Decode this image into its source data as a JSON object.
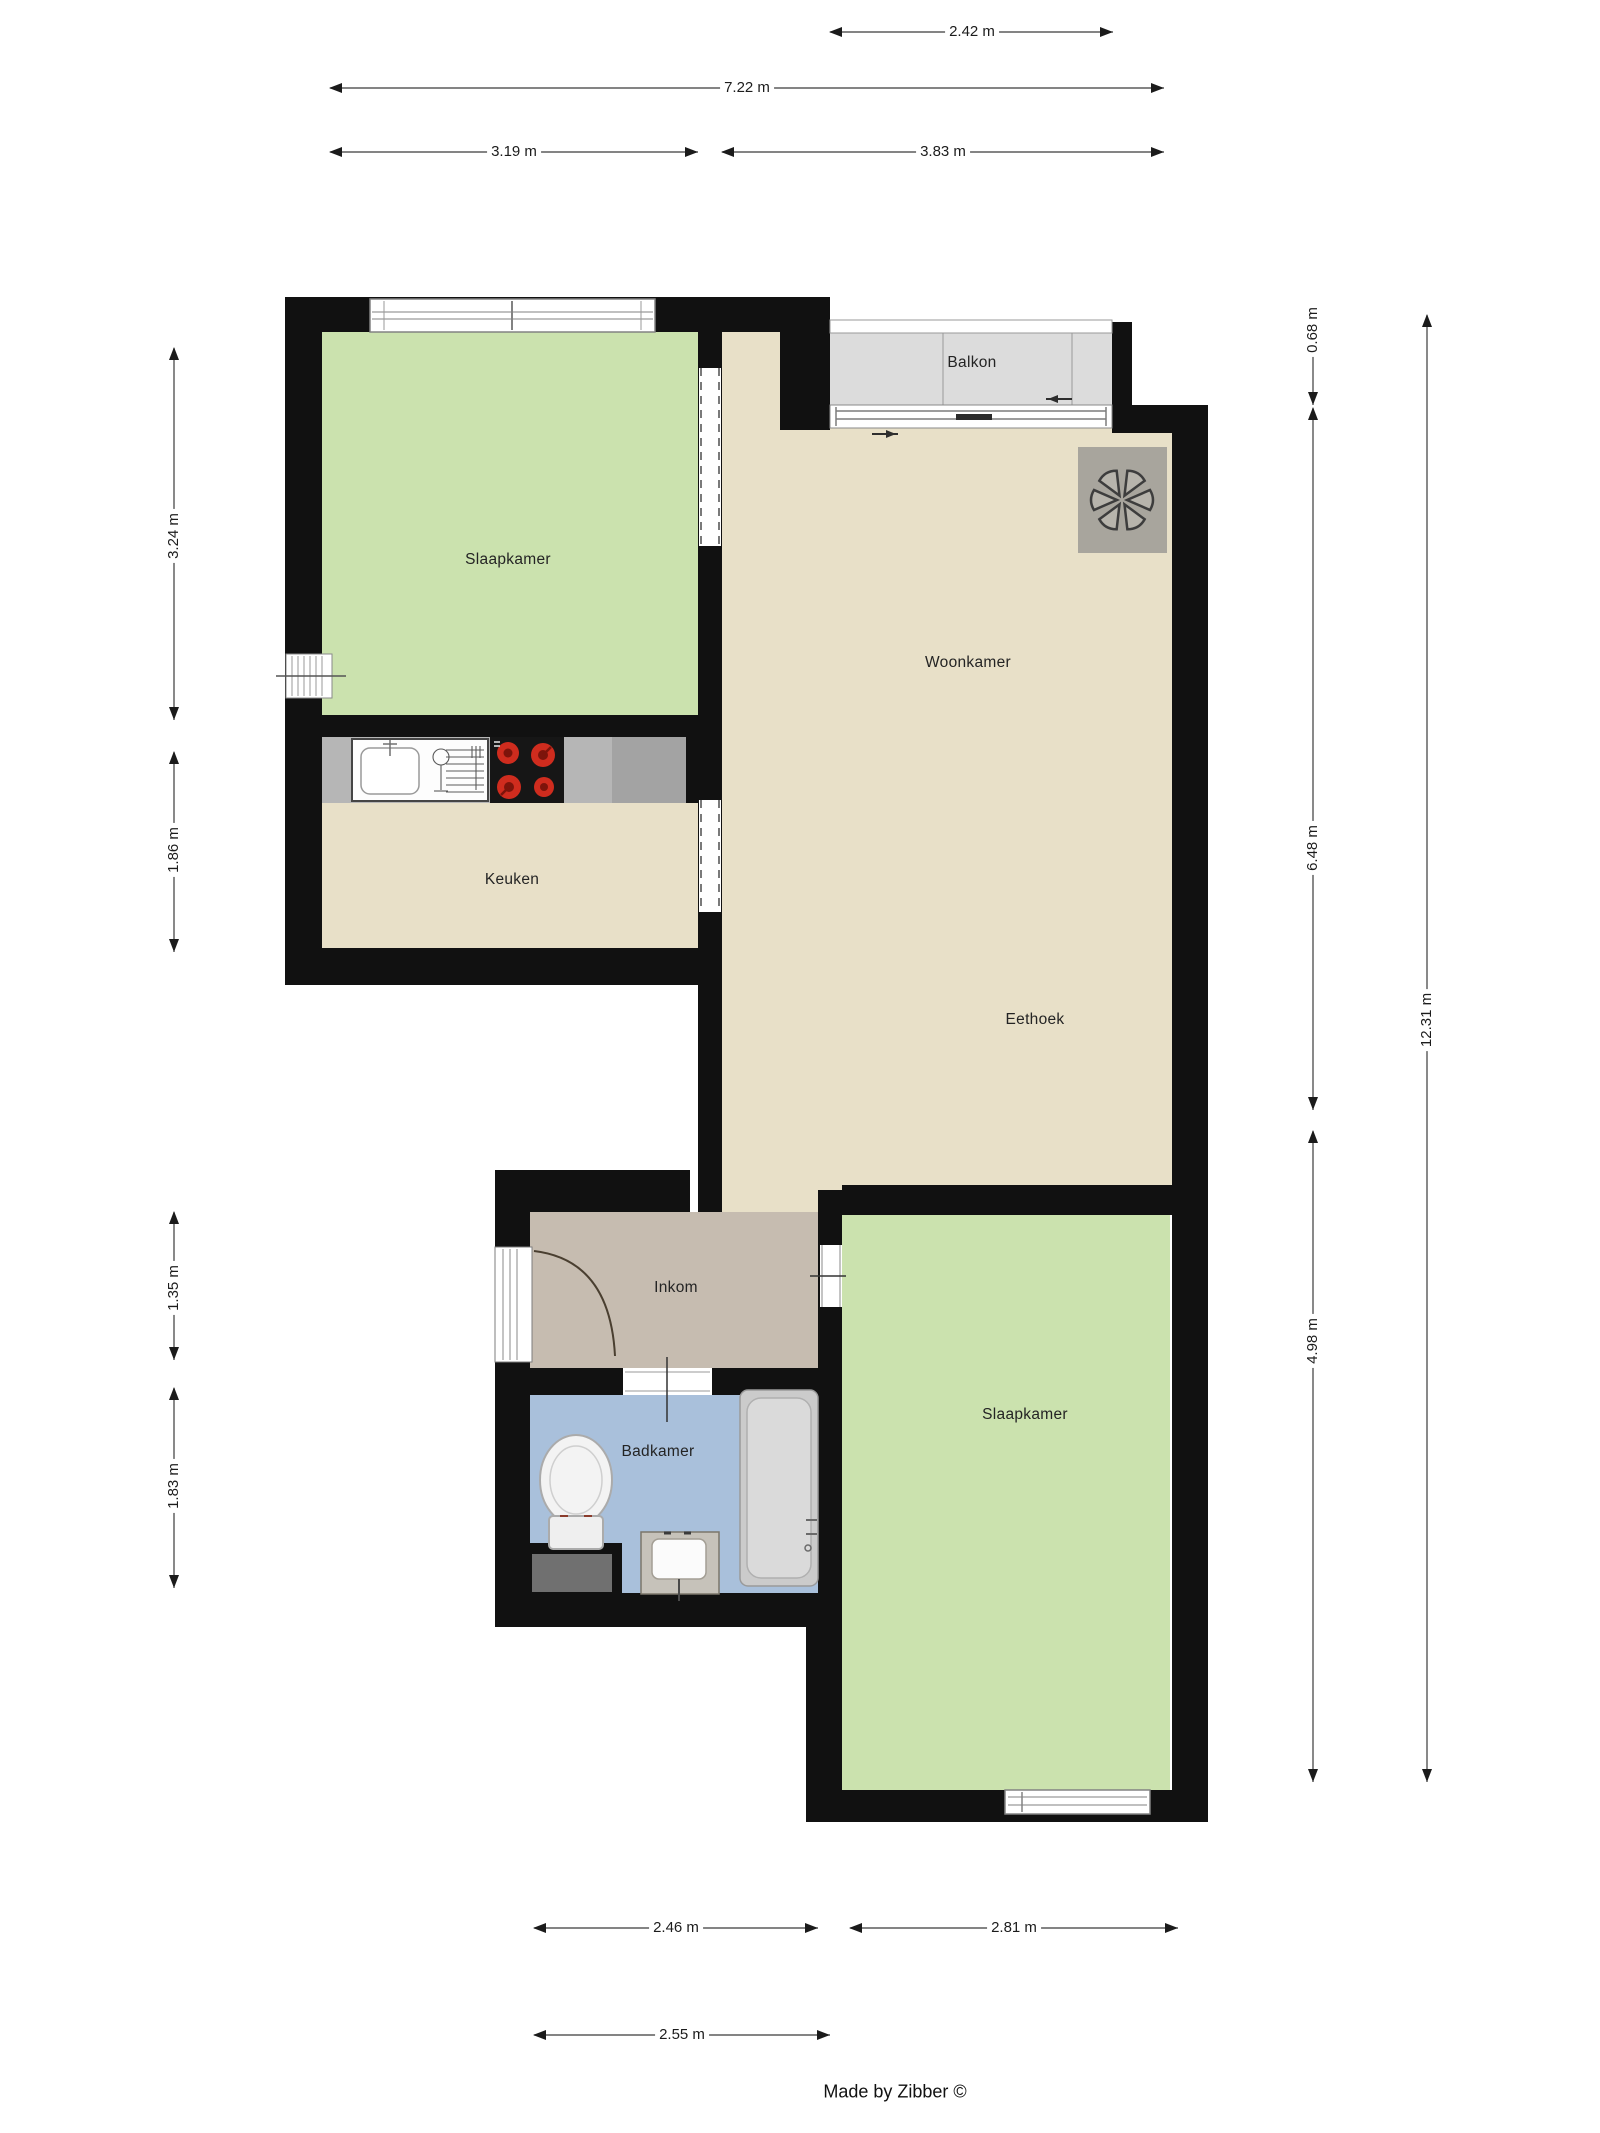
{
  "title": "Apartment floor plan",
  "credit": {
    "label": "Made by Zibber ©"
  },
  "rooms": {
    "slaapkamer_1": {
      "label": "Slaapkamer"
    },
    "woonkamer": {
      "label": "Woonkamer"
    },
    "eethoek": {
      "label": "Eethoek"
    },
    "keuken": {
      "label": "Keuken"
    },
    "balkon": {
      "label": "Balkon"
    },
    "inkom": {
      "label": "Inkom"
    },
    "badkamer": {
      "label": "Badkamer"
    },
    "slaapkamer_2": {
      "label": "Slaapkamer"
    }
  },
  "dimensions": {
    "top": {
      "balcony_width": {
        "label": "2.42 m",
        "meters": 2.42
      },
      "total_width": {
        "label": "7.22 m",
        "meters": 7.22
      },
      "left_width": {
        "label": "3.19 m",
        "meters": 3.19
      },
      "right_width": {
        "label": "3.83 m",
        "meters": 3.83
      }
    },
    "left": {
      "bedroom1_height": {
        "label": "3.24 m",
        "meters": 3.24
      },
      "kitchen_height": {
        "label": "1.86 m",
        "meters": 1.86
      },
      "entrance_height": {
        "label": "1.35 m",
        "meters": 1.35
      },
      "bathroom_height": {
        "label": "1.83 m",
        "meters": 1.83
      }
    },
    "right": {
      "balcony_depth": {
        "label": "0.68 m",
        "meters": 0.68
      },
      "living_height": {
        "label": "6.48 m",
        "meters": 6.48
      },
      "total_height": {
        "label": "12.31 m",
        "meters": 12.31
      },
      "bedroom2_height": {
        "label": "4.98 m",
        "meters": 4.98
      }
    },
    "bottom": {
      "bathroom_width": {
        "label": "2.46 m",
        "meters": 2.46
      },
      "bedroom2_width": {
        "label": "2.81 m",
        "meters": 2.81
      },
      "entrance_width": {
        "label": "2.55 m",
        "meters": 2.55
      }
    }
  },
  "colors": {
    "wall": "#111111",
    "bedroom": "#cbe2ae",
    "living": "#e8e0c8",
    "entrance": "#c6bcb0",
    "bathroom": "#a9c0db",
    "balcony": "#dcdcdc",
    "counter": "#b6b6b6",
    "counter_dark": "#a3a3a3",
    "stove": "#161616",
    "burner_red": "#cf2c1e",
    "burner_core": "#7d140b",
    "fixture_gray": "#cbcbcb",
    "washer_gray": "#707070",
    "fan_plate": "#a8a59d",
    "dimension_line": "#3b3b3b"
  },
  "icons": {
    "fan": "extractor-fan-icon",
    "bath": "bathtub-icon",
    "toilet": "toilet-icon",
    "washbasin": "washbasin-icon",
    "washer": "washing-machine-icon",
    "stove": "stove-icon",
    "kitchen_sink": "kitchen-sink-icon",
    "dish_rack": "dish-rack-icon",
    "entry_door": "door-swing-icon",
    "slide_arrows": "slide-direction-arrow-icon"
  }
}
